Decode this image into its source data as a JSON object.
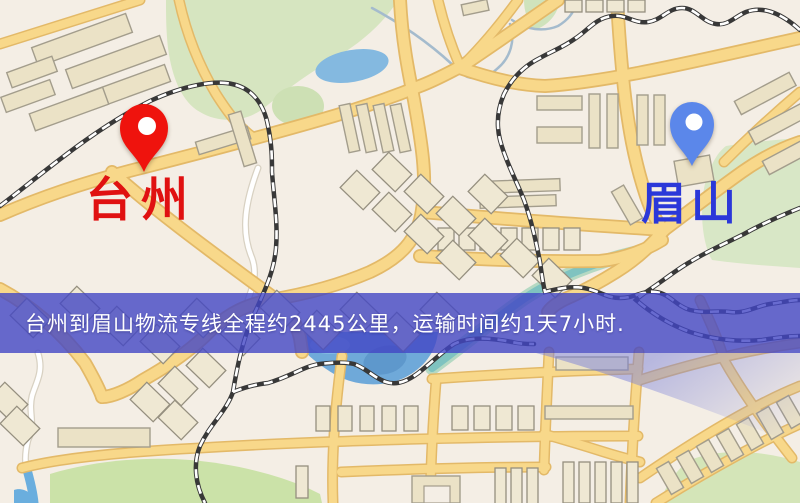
{
  "banner": {
    "text": "台州到眉山物流专线全程约2445公里，运输时间约1天7小时.",
    "bg_style": "background-color: rgba(66,70,196,0.8)",
    "text_color": "#ffffff"
  },
  "markers": {
    "origin": {
      "label": "台州",
      "pin_color": "#ef130d",
      "label_color": "#e01111"
    },
    "destination": {
      "label": "眉山",
      "pin_color": "#5b87ea",
      "label_color": "#2b38d9"
    }
  },
  "map": {
    "colors": {
      "background": "#f4eee5",
      "park": "#d6e5c0",
      "park_bright": "#cbe2a8",
      "water": "#7fb3de",
      "lake": "#6fa9d9",
      "road_fill": "#f8d88a",
      "road_casing": "#e3b968",
      "building": "#ebe2c6",
      "railway": "#383838",
      "water_overlay": "rgba(122,128,216,0.45)"
    }
  }
}
